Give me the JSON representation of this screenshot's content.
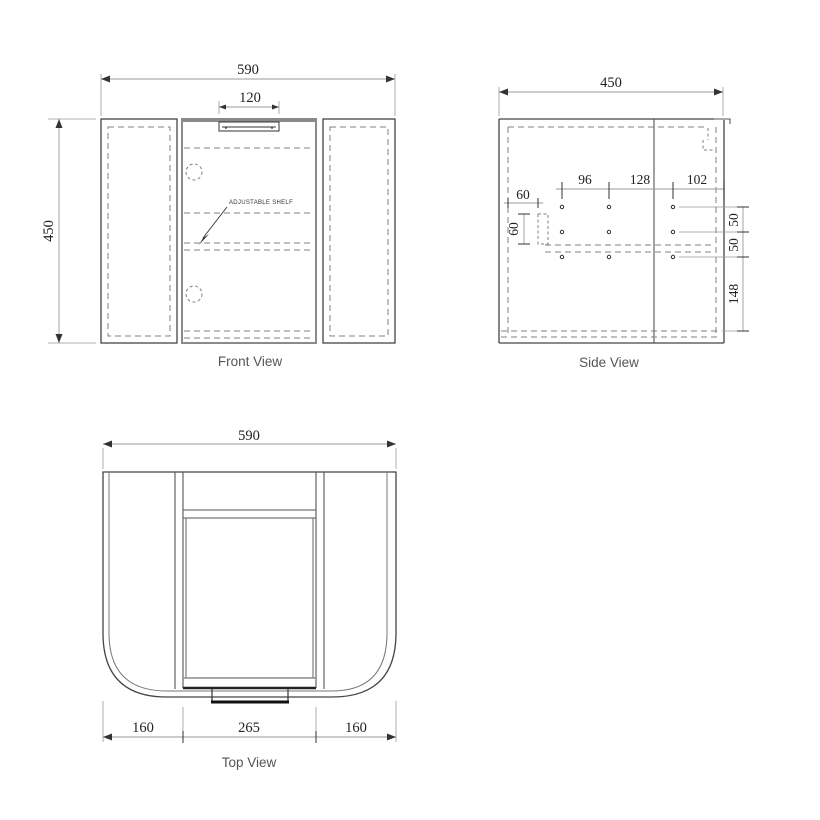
{
  "drawing": {
    "type": "vanity-cabinet-technical-drawing",
    "colors": {
      "line": "#444444",
      "hidden_line": "#808080",
      "door_edge": "#8a8a8a",
      "dimension_text": "#222222",
      "label_text": "#555555",
      "background": "#ffffff"
    },
    "front_view": {
      "label": "Front View",
      "width_dim": "590",
      "handle_width_dim": "120",
      "height_dim": "450",
      "shelf_note": "ADJUSTABLE SHELF"
    },
    "side_view": {
      "label": "Side View",
      "depth_dim": "450",
      "hole_spacing_a": "96",
      "hole_spacing_b": "128",
      "hole_spacing_c": "102",
      "back_offset_dim": "60",
      "bracket_height_dim": "60",
      "row_gap_a": "50",
      "row_gap_b": "50",
      "bottom_gap": "148"
    },
    "top_view": {
      "label": "Top View",
      "width_dim": "590",
      "left_wing_dim": "160",
      "door_width_dim": "265",
      "right_wing_dim": "160"
    }
  }
}
